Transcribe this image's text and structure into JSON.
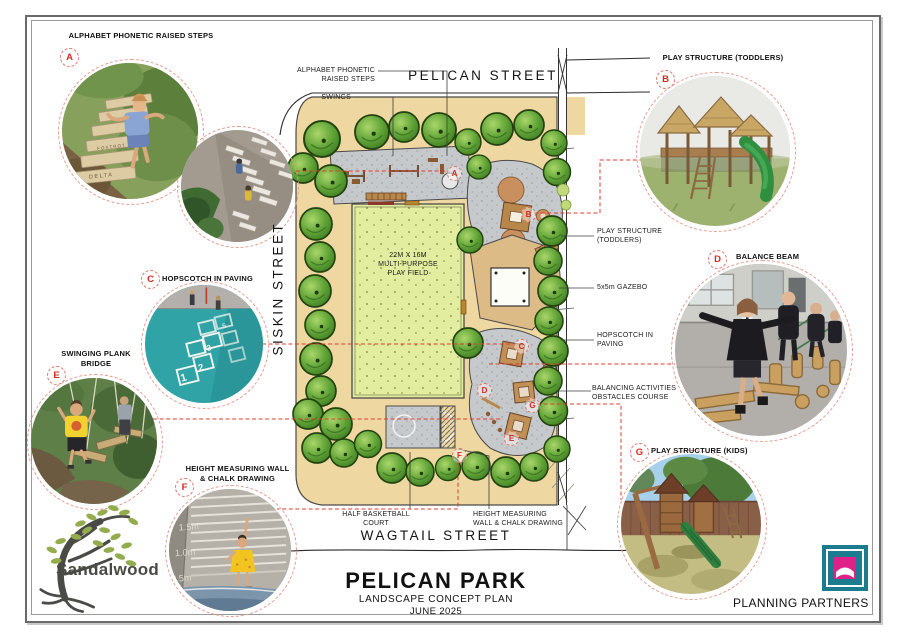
{
  "callouts": [
    {
      "letter": "A",
      "title": "ALPHABET PHONETIC RAISED STEPS"
    },
    {
      "letter": "B",
      "title": "PLAY STRUCTURE (TODDLERS)"
    },
    {
      "letter": "C",
      "title": "HOPSCOTCH IN PAVING"
    },
    {
      "letter": "D",
      "title": "BALANCE BEAM"
    },
    {
      "letter": "E",
      "title": "SWINGING PLANK\nBRIDGE"
    },
    {
      "letter": "F",
      "title": "HEIGHT MEASURING WALL\n& CHALK DRAWING"
    },
    {
      "letter": "G",
      "title": "PLAY STRUCTURE (KIDS)"
    }
  ],
  "plan": {
    "streets": {
      "top": "PELICAN STREET",
      "left": "SISKIN STREET",
      "bottom": "WAGTAIL STREET"
    },
    "labels": {
      "alphabet_steps": "ALPHABET PHONETIC\nRAISED STEPS",
      "swings": "SWINGS",
      "play_field": "22M X 16M\nMULTI-PURPOSE\nPLAY FIELD",
      "toddlers": "PLAY STRUCTURE\n(TODDLERS)",
      "gazebo": "5x5m GAZEBO",
      "hopscotch": "HOPSCOTCH IN\nPAVING",
      "balancing": "BALANCING ACTIVITIES\nOBSTACLES COURSE",
      "basketball": "HALF BASKETBALL\nCOURT",
      "height_wall": "HEIGHT MEASURING\nWALL & CHALK DRAWING"
    }
  },
  "photo_f": {
    "scale": [
      "1.5m",
      "1.0m",
      "0.5m"
    ]
  },
  "title_block": {
    "title": "PELICAN PARK",
    "subtitle": "LANDSCAPE CONCEPT PLAN",
    "date": "JUNE 2025"
  },
  "logos": {
    "sandalwood": "Sandalwood",
    "planning_partners": "PLANNING PARTNERS"
  },
  "colors": {
    "accent_red": "#d7281c",
    "sand": "#eed7a0",
    "field_green": "#e3ed9f",
    "tree_green": "#5a9c33",
    "paving_gray": "#c6c9cc",
    "teal_logo": "#1a7c8c",
    "magenta_logo": "#e0218a"
  }
}
